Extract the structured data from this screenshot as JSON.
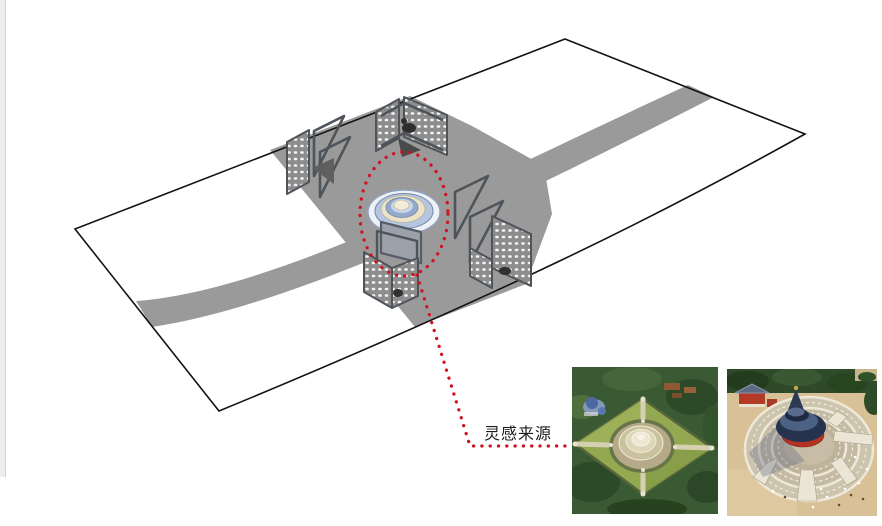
{
  "window": {
    "width": "882",
    "height": "526",
    "background": "#ffffff"
  },
  "diagram": {
    "annotation_label": "灵感来源",
    "colors": {
      "outline": "#141414",
      "road": "#9a9a9a",
      "structure_frame": "#4f545a",
      "panel_gray": "#8d8d8d",
      "accent_red": "#cf1322",
      "dome_ring_outer": "#b6c6e0",
      "dome_ring_cream": "#ebe3c6",
      "dome_ring_mid": "#93aacd",
      "dome_ring_inner": "#c9d5e8",
      "dome_top": "#f2ecd8"
    }
  },
  "photos": {
    "left": {
      "icon": "aerial-photo-circular-mound-altar"
    },
    "right": {
      "icon": "aerial-photo-temple-of-heaven"
    }
  }
}
